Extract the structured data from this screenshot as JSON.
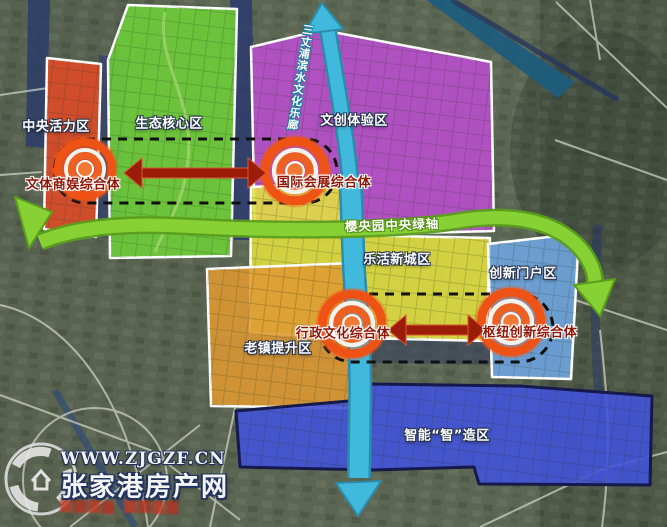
{
  "map": {
    "zones": [
      {
        "id": "central-vitality",
        "label": "中央活力区",
        "color": "#e04a26"
      },
      {
        "id": "eco-core",
        "label": "生态核心区",
        "color": "#6ecf38"
      },
      {
        "id": "cultural-creative",
        "label": "文创体验区",
        "color": "#bb4ecf"
      },
      {
        "id": "lohas-newtown",
        "label": "乐活新城区",
        "color": "#e4e040"
      },
      {
        "id": "innovation-gateway",
        "label": "创新门户区",
        "color": "#6fa6e2"
      },
      {
        "id": "oldtown-upgrade",
        "label": "老镇提升区",
        "color": "#df9a32"
      },
      {
        "id": "smart-manufacturing",
        "label": "智能“智”造区",
        "color": "#4353d8"
      }
    ],
    "complexes": [
      {
        "label": "文体商娱综合体"
      },
      {
        "label": "国际会展综合体"
      },
      {
        "label": "行政文化综合体"
      },
      {
        "label": "枢纽创新综合体"
      }
    ],
    "axes": {
      "central_green_axis": "樱央园中央绿轴",
      "waterfront_culture_corridor": "三丈浦滨水文化乐廊"
    },
    "accent_colors": {
      "link_arrow_red": "#9b1c08",
      "green_axis": "#88d134",
      "river_teal": "#41b9dc"
    }
  },
  "watermark": {
    "website": "WWW.ZJGZF.CN",
    "site_name": "张家港房产网"
  }
}
